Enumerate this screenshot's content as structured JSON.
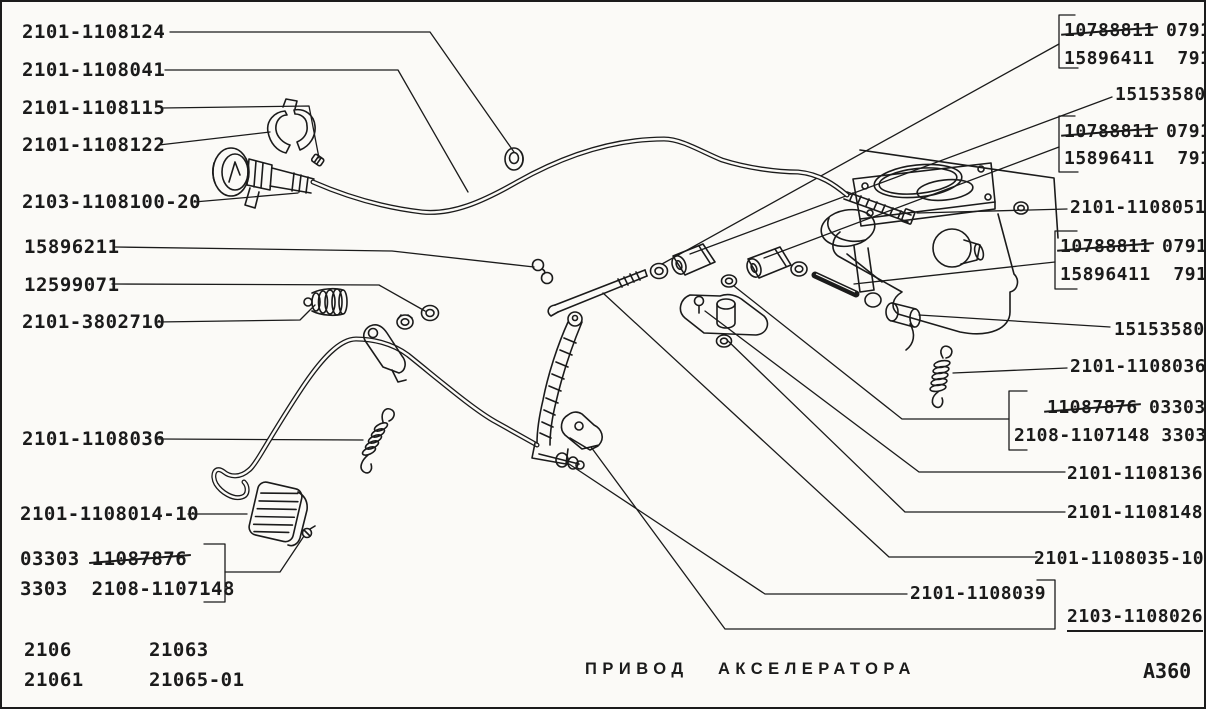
{
  "page": {
    "caption_words": [
      "ПРИВОД",
      "АКСЕЛЕРАТОРА"
    ],
    "drawing_number": "А360",
    "ink_color": "#1b1b1b",
    "background_color": "#fbfaf7"
  },
  "labels": [
    {
      "text": "2101-1108124",
      "side": "left",
      "x": 20,
      "y": 19
    },
    {
      "text": "2101-1108041",
      "side": "left",
      "x": 20,
      "y": 57
    },
    {
      "text": "2101-1108115",
      "side": "left",
      "x": 20,
      "y": 95
    },
    {
      "text": "2101-1108122",
      "side": "left",
      "x": 20,
      "y": 132
    },
    {
      "text": "2103-1108100-20",
      "side": "left",
      "x": 20,
      "y": 189
    },
    {
      "text": "15896211",
      "side": "left",
      "x": 22,
      "y": 234
    },
    {
      "text": "12599071",
      "side": "left",
      "x": 22,
      "y": 272
    },
    {
      "text": "2101-3802710",
      "side": "left",
      "x": 20,
      "y": 309
    },
    {
      "text": "2101-1108036",
      "side": "left",
      "x": 20,
      "y": 426
    },
    {
      "text": "2101-1108014-10",
      "side": "left",
      "x": 18,
      "y": 501
    },
    {
      "text": "03303 11087876",
      "strike": "11087876",
      "side": "left",
      "x": 18,
      "y": 546
    },
    {
      "text": "3303  2108-1107148",
      "side": "left",
      "x": 18,
      "y": 576
    },
    {
      "text": "2106",
      "side": "left",
      "x": 22,
      "y": 637
    },
    {
      "text": "21063",
      "side": "left",
      "x": 147,
      "y": 637
    },
    {
      "text": "21061",
      "side": "left",
      "x": 22,
      "y": 667
    },
    {
      "text": "21065-01",
      "side": "left",
      "x": 147,
      "y": 667
    },
    {
      "text": "10788811 0791",
      "strike": "10788811",
      "side": "right",
      "x": 1062,
      "y": 18
    },
    {
      "text": "15896411  791",
      "side": "right",
      "x": 1062,
      "y": 46
    },
    {
      "text": "15153580",
      "side": "right",
      "x": 1113,
      "y": 82
    },
    {
      "text": "10788811 0791",
      "strike": "10788811",
      "side": "right",
      "x": 1062,
      "y": 119
    },
    {
      "text": "15896411  791",
      "side": "right",
      "x": 1062,
      "y": 146
    },
    {
      "text": "2101-1108051",
      "side": "right",
      "x": 1068,
      "y": 195
    },
    {
      "text": "10788811 0791",
      "strike": "10788811",
      "side": "right",
      "x": 1058,
      "y": 234
    },
    {
      "text": "15896411  791",
      "side": "right",
      "x": 1058,
      "y": 262
    },
    {
      "text": "15153580",
      "side": "right",
      "x": 1112,
      "y": 317
    },
    {
      "text": "2101-1108036",
      "side": "right",
      "x": 1068,
      "y": 354
    },
    {
      "text": "11087876 03303",
      "strike": "11087876",
      "side": "right",
      "x": 1045,
      "y": 395
    },
    {
      "text": "2108-1107148 3303",
      "side": "right",
      "x": 1012,
      "y": 423
    },
    {
      "text": "2101-1108136",
      "side": "right",
      "x": 1065,
      "y": 461
    },
    {
      "text": "2101-1108148",
      "side": "right",
      "x": 1065,
      "y": 500
    },
    {
      "text": "2101-1108035-10",
      "side": "right",
      "x": 1032,
      "y": 546
    },
    {
      "text": "2101-1108039",
      "side": "right",
      "x": 908,
      "y": 581
    },
    {
      "text": "2103-1108026",
      "underline": true,
      "side": "right",
      "x": 1065,
      "y": 604
    }
  ]
}
